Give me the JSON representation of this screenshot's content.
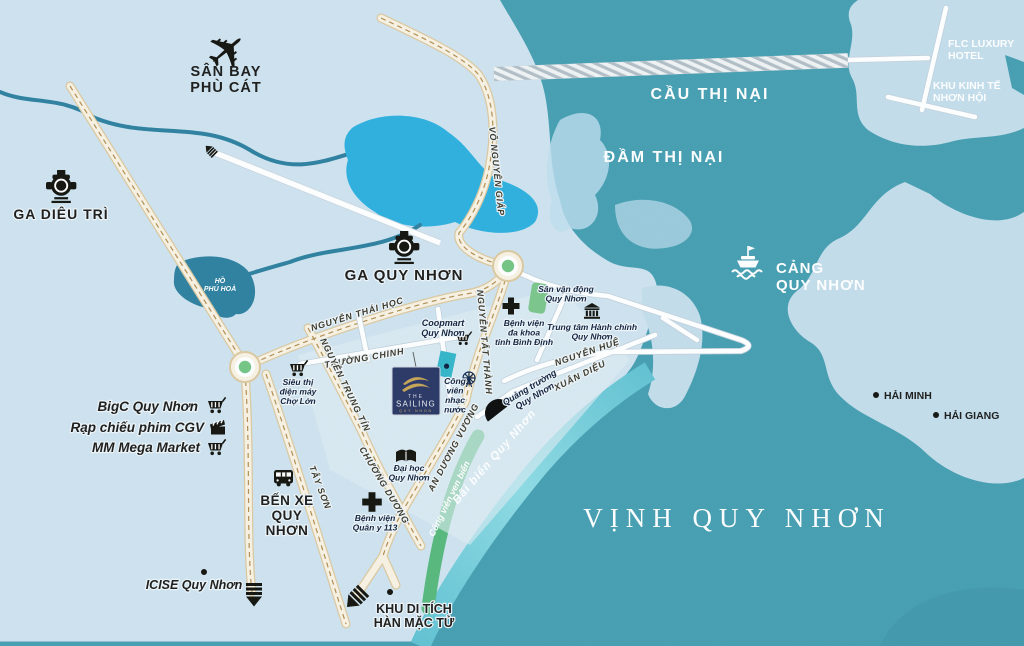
{
  "water": {
    "bay": "VỊNH QUY NHƠN",
    "lagoon": "ĐẦM THỊ NẠI",
    "bridge": "CẦU THỊ NẠI",
    "pond": "HỒ\nPHÚ HOÀ",
    "beach": "Bãi biển Quy Nhơn",
    "coastal_park": "Công viên ven biển"
  },
  "places": {
    "airport": "SÂN BAY\nPHÙ CÁT",
    "dieu_tri_station": "GA DIÊU TRÌ",
    "quy_nhon_station": "GA QUY NHƠN",
    "bus_station": "BẾN XE\nQUY\nNHƠN",
    "port": "CẢNG\nQUY NHƠN",
    "flc_hotel": "FLC LUXURY\nHOTEL",
    "nhon_hoi": "KHU KINH TẾ\nNHƠN HỘI",
    "hai_minh": "HẢI MINH",
    "hai_giang": "HẢI GIANG",
    "han_mac_tu": "KHU DI TÍCH\nHÀN MẶC TỬ",
    "icise": "ICISE Quy Nhơn",
    "bigc": "BigC Quy Nhơn",
    "cgv": "Rạp chiếu phim CGV",
    "mega_market": "MM Mega Market",
    "cho_lon": "Siêu thị\nđiện máy\nChợ Lớn",
    "coopmart": "Coopmart\nQuy Nhơn",
    "hospital_provincial": "Bệnh viện\nđa khoa\ntỉnh Bình Định",
    "stadium": "Sân vận động\nQuy Nhơn",
    "admin_center": "Trung tâm Hành chính\nQuy Nhơn",
    "music_park": "Công\nviên\nnhạc\nnước",
    "square": "Quảng trường\nQuy Nhơn",
    "university": "Đại học\nQuy Nhơn",
    "hospital_military": "Bệnh viện\nQuân y 113"
  },
  "roads": {
    "vo_nguyen_giap": "VÕ NGUYÊN GIÁP",
    "nguyen_thai_hoc": "NGUYỄN THÁI HỌC",
    "nguyen_tat_thanh": "NGUYỄN TẤT THÀNH",
    "truong_chinh": "TRƯỜNG CHINH",
    "nguyen_trung_tin": "NGUYỄN TRUNG TÍN",
    "chuong_duong": "CHƯƠNG DƯƠNG",
    "tay_son": "TÂY SƠN",
    "nguyen_hue": "NGUYỄN HUỆ",
    "xuan_dieu": "XUÂN DIỆU",
    "an_duong_vuong": "AN DƯƠNG VƯƠNG"
  },
  "logo": {
    "the": "THE",
    "name": "SAILING",
    "city": "QUY NHON"
  },
  "colors": {
    "land": "#cfe3ef",
    "sea": "#479fb2",
    "bright_lake": "#2fb0de",
    "dark_pond": "#2f81a0",
    "tidal_flat": "#bedded",
    "road_main": "#f8f2e3",
    "road_dash": "#b28e52",
    "street": "#ffffff",
    "beach_strip": "#7fd3de",
    "park_green": "#58b87c",
    "roundabout_green": "#74c585",
    "logo_navy": "#2b3866",
    "logo_gold": "#c7a557",
    "ink": "#1d1d1b"
  }
}
